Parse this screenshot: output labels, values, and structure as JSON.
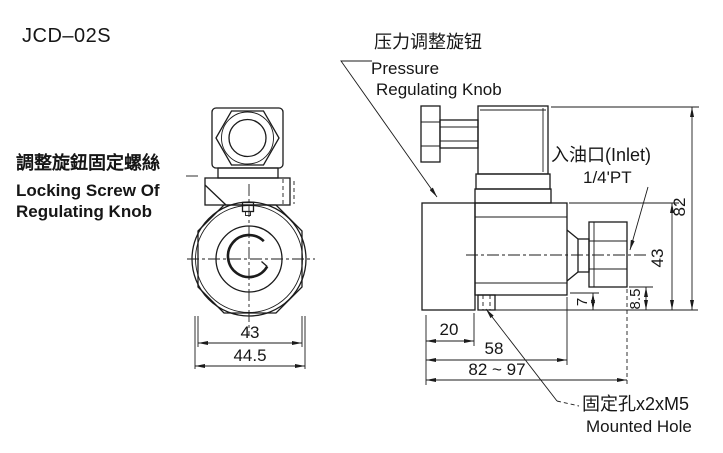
{
  "drawing_title": "JCD–02S",
  "labels": {
    "locking_screw_zh": "調整旋鈕固定螺絲",
    "locking_screw_en1": "Locking Screw Of",
    "locking_screw_en2": "Regulating Knob",
    "pressure_zh": "压力调整旋钮",
    "pressure_en1": "Pressure",
    "pressure_en2": "Regulating Knob",
    "inlet_zh": "入油口(Inlet)",
    "inlet_size": "1/4'PT",
    "mount_zh": "固定孔x2xM5",
    "mount_en": "Mounted Hole"
  },
  "dims": {
    "front_across_flats": "43",
    "front_overall": "44.5",
    "knob_length": "20",
    "body_length": "58",
    "overall_length": "82 ~ 97",
    "step_height": "7",
    "port_height": "8.5",
    "body_height": "43",
    "overall_height": "82"
  },
  "colors": {
    "ink": "#1b1b1b",
    "background": "#ffffff"
  }
}
